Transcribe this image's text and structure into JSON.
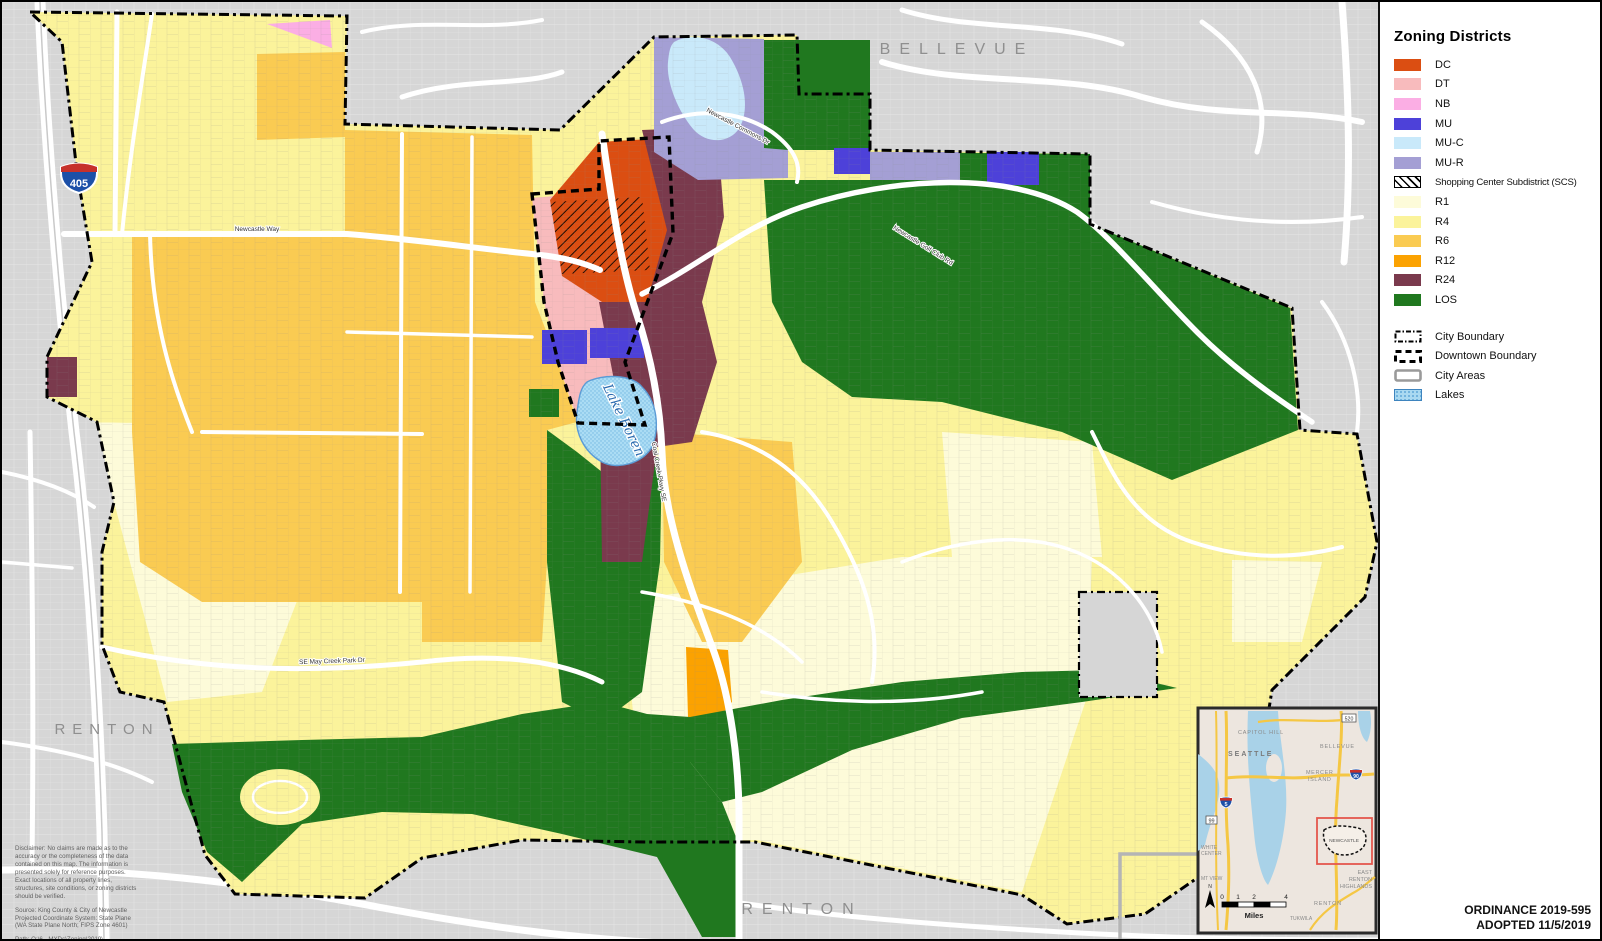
{
  "legend": {
    "title": "Zoning Districts",
    "districts": [
      {
        "code": "DC",
        "color": "#DB4E12"
      },
      {
        "code": "DT",
        "color": "#F8BBBD"
      },
      {
        "code": "NB",
        "color": "#FBAEE4"
      },
      {
        "code": "MU",
        "color": "#4D41D9"
      },
      {
        "code": "MU-C",
        "color": "#C9E9FA"
      },
      {
        "code": "MU-R",
        "color": "#A49FD4"
      },
      {
        "code": "SCS",
        "label": "Shopping Center Subdistrict (SCS)",
        "hatched": true
      },
      {
        "code": "R1",
        "color": "#FDFBD9"
      },
      {
        "code": "R4",
        "color": "#FBF39B"
      },
      {
        "code": "R6",
        "color": "#FACB52"
      },
      {
        "code": "R12",
        "color": "#FBA201"
      },
      {
        "code": "R24",
        "color": "#7A3A4D"
      },
      {
        "code": "LOS",
        "color": "#20781F"
      }
    ],
    "boundaries": [
      {
        "label": "City Boundary"
      },
      {
        "label": "Downtown Boundary"
      },
      {
        "label": "City Areas"
      },
      {
        "label": "Lakes",
        "color": "#A9D9F1"
      }
    ]
  },
  "ordinance": {
    "line1": "ORDINANCE 2019-595",
    "line2": "ADOPTED 11/5/2019"
  },
  "map_labels": {
    "bellevue": "BELLEVUE",
    "renton_west": "RENTON",
    "renton_south": "RENTON",
    "lake": "Lake Boren",
    "i405": "405"
  },
  "road_labels": {
    "coal_creek": "Coal Creek Pkwy SE",
    "golf_club": "Newcastle Golf Club Rd",
    "newcastle_way": "Newcastle Way",
    "may_creek": "SE May Creek Park Dr",
    "commons": "Newcastle Commons Dr"
  },
  "notes": {
    "disclaimer": [
      "Disclaimer: No claims are made as to the",
      "accuracy or the completeness of the data",
      "contained on this map. The information is",
      "presented solely for reference purposes.",
      "Exact locations of all property lines,",
      "structures, site conditions, or zoning districts",
      "should be verified."
    ],
    "source": [
      "Source: King County & City of Newcastle",
      "Projected Coordinate System: State Plane",
      "(WA State Plane North; FIPS Zone 4601)"
    ],
    "path": "Path: Q:\\6 - MXDs\\Zoning\\2019\\",
    "date": "Date: 11/25/2019 3:28 PM",
    "user": "User: waylandb"
  },
  "inset": {
    "labels": {
      "capitol_hill": "CAPITOL HILL",
      "seattle": "SEATTLE",
      "bellevue": "BELLEVUE",
      "mercer1": "MERCER",
      "mercer2": "ISLAND",
      "newcastle": "NEWCASTLE",
      "white1": "WHITE",
      "white2": "CENTER",
      "mtview": "MT VIEW",
      "east1": "EAST",
      "east2": "RENTON",
      "east3": "HIGHLANDS",
      "renton": "RENTON",
      "tukwila": "TUKWILA"
    },
    "scale": {
      "t0": "0",
      "t1": "1",
      "t2": "2",
      "t4": "4",
      "unit": "Miles",
      "north": "N"
    },
    "shields": {
      "i5": "5",
      "i90": "90",
      "sr520": "520",
      "sr99": "99"
    }
  }
}
